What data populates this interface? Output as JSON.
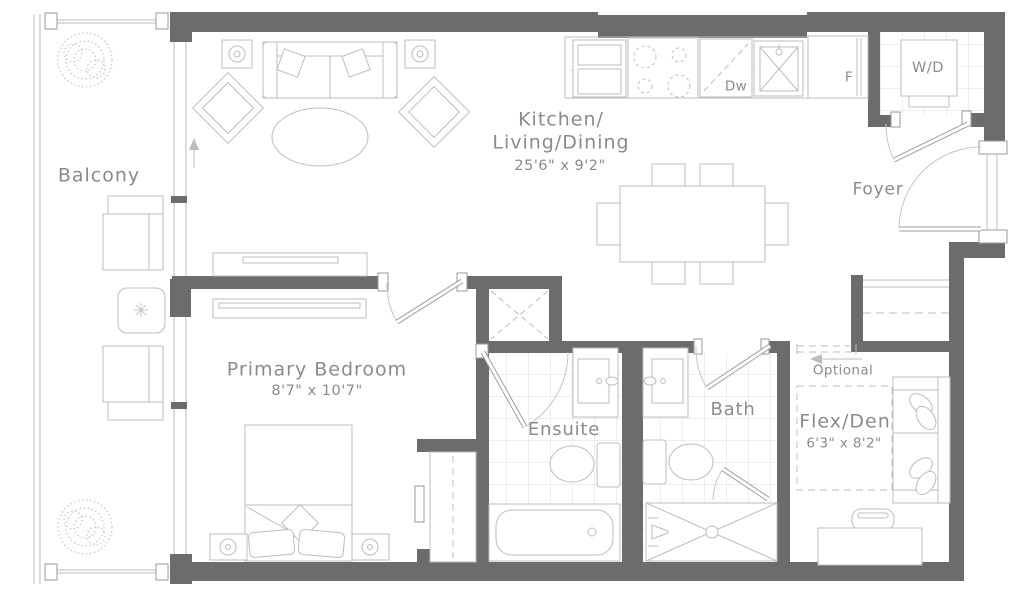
{
  "plan": {
    "colors": {
      "wall": "#6c6c6c",
      "line": "#bdbdbd",
      "line_light": "#dedede",
      "door": "#9f9f9f",
      "text": "#8b8b8b"
    },
    "rooms": {
      "balcony": {
        "label": "Balcony"
      },
      "kitchen_living_dining": {
        "line1": "Kitchen/",
        "line2": "Living/Dining",
        "dims": "25'6\" x 9'2\""
      },
      "foyer": {
        "label": "Foyer"
      },
      "primary_bedroom": {
        "label": "Primary Bedroom",
        "dims": "8'7\" x 10'7\""
      },
      "ensuite": {
        "label": "Ensuite"
      },
      "bath": {
        "label": "Bath"
      },
      "flex_den": {
        "label": "Flex/Den",
        "dims": "6'3\" x 8'2\""
      }
    },
    "appliances": {
      "washer_dryer": "W/D",
      "dishwasher": "Dw",
      "fridge": "F"
    },
    "annotations": {
      "optional": "Optional"
    }
  }
}
